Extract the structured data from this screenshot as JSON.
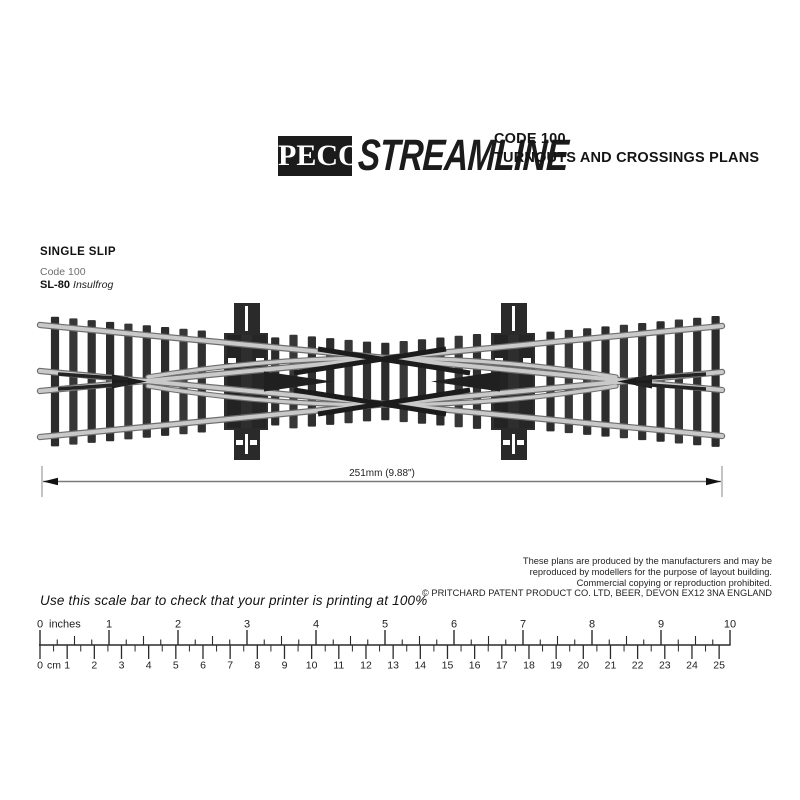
{
  "header": {
    "brand": "PECO",
    "wordmark": "STREAMLINE",
    "line1": "CODE 100",
    "line2": "TURNOUTS AND CROSSINGS PLANS"
  },
  "product": {
    "title": "SINGLE SLIP",
    "code": "Code 100",
    "sku": "SL-80",
    "variant": "Insulfrog"
  },
  "diagram": {
    "description": "single-slip-track-photo",
    "dimension": "251mm (9.88\")"
  },
  "legal": {
    "lines": [
      "These plans are produced by the manufacturers and may be",
      "reproduced by modellers for the purpose of layout building.",
      "Commercial copying or reproduction prohibited.",
      "© PRITCHARD PATENT PRODUCT CO. LTD, BEER, DEVON EX12 3NA ENGLAND"
    ]
  },
  "scalebar": {
    "instruction": "Use this scale bar to check that your printer is printing at 100%",
    "unit_inches": "inches",
    "unit_cm": "cm",
    "inch_labels": [
      "0",
      "1",
      "2",
      "3",
      "4",
      "5",
      "6",
      "7",
      "8",
      "9",
      "10"
    ],
    "cm_labels": [
      "0",
      "1",
      "2",
      "3",
      "4",
      "5",
      "6",
      "7",
      "8",
      "9",
      "10",
      "11",
      "12",
      "13",
      "14",
      "15",
      "16",
      "17",
      "18",
      "19",
      "20",
      "21",
      "22",
      "23",
      "24",
      "25"
    ]
  },
  "colors": {
    "ink": "#1b1b1b",
    "rail": "#c9c9c9",
    "sleeper": "#2f2f2f",
    "dimension_line": "#7a7a7a"
  }
}
